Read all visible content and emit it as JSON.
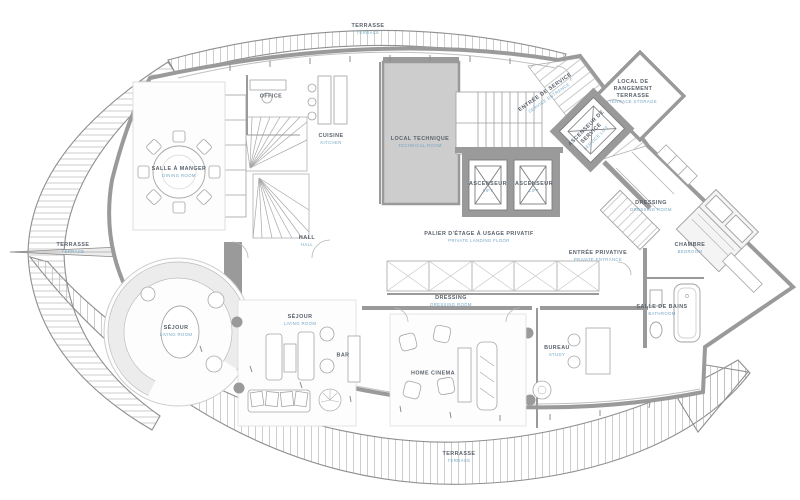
{
  "title": "Penthouse floor plan",
  "colors": {
    "wall": "#9a9a9a",
    "wall_light": "#cdcdcd",
    "line": "#9f9f9f",
    "label_dark": "#5a626b",
    "label_blue": "#74a7c6",
    "background": "#ffffff"
  },
  "rooms": [
    {
      "id": "terrasse-left",
      "label": "TERRASSE",
      "sub": "TERRACE",
      "x": 73,
      "y": 248,
      "rot": 0,
      "wrap": false
    },
    {
      "id": "terrasse-top",
      "label": "TERRASSE",
      "sub": "TERRACE",
      "x": 368,
      "y": 29,
      "rot": 0,
      "wrap": false
    },
    {
      "id": "terrasse-bottom",
      "label": "TERRASSE",
      "sub": "TERRACE",
      "x": 459,
      "y": 457,
      "rot": 0,
      "wrap": false
    },
    {
      "id": "salle-a-manger",
      "label": "SALLE À MANGER",
      "sub": "DINING ROOM",
      "x": 179,
      "y": 172,
      "rot": 0,
      "wrap": false
    },
    {
      "id": "office",
      "label": "OFFICE",
      "sub": "",
      "x": 271,
      "y": 97,
      "rot": 0,
      "wrap": false
    },
    {
      "id": "cuisine",
      "label": "CUISINE",
      "sub": "KITCHEN",
      "x": 331,
      "y": 139,
      "rot": 0,
      "wrap": false
    },
    {
      "id": "local-technique",
      "label": "LOCAL TECHNIQUE",
      "sub": "TECHNICAL ROOM",
      "x": 420,
      "y": 142,
      "rot": 0,
      "wrap": false
    },
    {
      "id": "entree-de-service",
      "label": "ENTRÉE DE SERVICE",
      "sub": "SERVICE ENTRANCE",
      "x": 547,
      "y": 95,
      "rot": -35,
      "wrap": false
    },
    {
      "id": "local-rangement-terrasse",
      "label": "LOCAL DE RANGEMENT TERRASSE",
      "sub": "TERRACE STORAGE",
      "x": 633,
      "y": 92,
      "rot": 0,
      "wrap": true
    },
    {
      "id": "ascenseur-de-service",
      "label": "ASCENSEUR DE SERVICE",
      "sub": "SERVICE LIFT",
      "x": 591,
      "y": 133,
      "rot": -45,
      "wrap": true
    },
    {
      "id": "ascenseur-1",
      "label": "ASCENSEUR",
      "sub": "LIFT",
      "x": 488,
      "y": 187,
      "rot": 0,
      "wrap": false
    },
    {
      "id": "ascenseur-2",
      "label": "ASCENSEUR",
      "sub": "LIFT",
      "x": 534,
      "y": 187,
      "rot": 0,
      "wrap": false
    },
    {
      "id": "hall",
      "label": "HALL",
      "sub": "HALL",
      "x": 307,
      "y": 241,
      "rot": 0,
      "wrap": false
    },
    {
      "id": "palier-etage",
      "label": "PALIER D'ÉTAGE À USAGE PRIVATIF",
      "sub": "PRIVATE LANDING FLOOR",
      "x": 479,
      "y": 237,
      "rot": 0,
      "wrap": false
    },
    {
      "id": "dressing-1",
      "label": "DRESSING",
      "sub": "DRESSING ROOM",
      "x": 451,
      "y": 301,
      "rot": 0,
      "wrap": false
    },
    {
      "id": "dressing-2",
      "label": "DRESSING",
      "sub": "DRESSING ROOM",
      "x": 651,
      "y": 206,
      "rot": 0,
      "wrap": false
    },
    {
      "id": "entree-privative",
      "label": "ENTRÉE PRIVATIVE",
      "sub": "PRIVATE ENTRANCE",
      "x": 598,
      "y": 256,
      "rot": 0,
      "wrap": false
    },
    {
      "id": "chambre",
      "label": "CHAMBRE",
      "sub": "BEDROOM",
      "x": 690,
      "y": 248,
      "rot": 0,
      "wrap": false
    },
    {
      "id": "salle-de-bains",
      "label": "SALLE DE BAINS",
      "sub": "BATHROOM",
      "x": 662,
      "y": 310,
      "rot": 0,
      "wrap": true
    },
    {
      "id": "sejour-rond",
      "label": "SÉJOUR",
      "sub": "LIVING ROOM",
      "x": 176,
      "y": 331,
      "rot": 0,
      "wrap": false
    },
    {
      "id": "sejour-2",
      "label": "SÉJOUR",
      "sub": "LIVING ROOM",
      "x": 300,
      "y": 320,
      "rot": 0,
      "wrap": false
    },
    {
      "id": "bar",
      "label": "BAR",
      "sub": "",
      "x": 343,
      "y": 356,
      "rot": 0,
      "wrap": false
    },
    {
      "id": "home-cinema",
      "label": "HOME CINEMA",
      "sub": "",
      "x": 433,
      "y": 374,
      "rot": 0,
      "wrap": false
    },
    {
      "id": "bureau",
      "label": "BUREAU",
      "sub": "STUDY",
      "x": 557,
      "y": 351,
      "rot": 0,
      "wrap": false
    }
  ]
}
